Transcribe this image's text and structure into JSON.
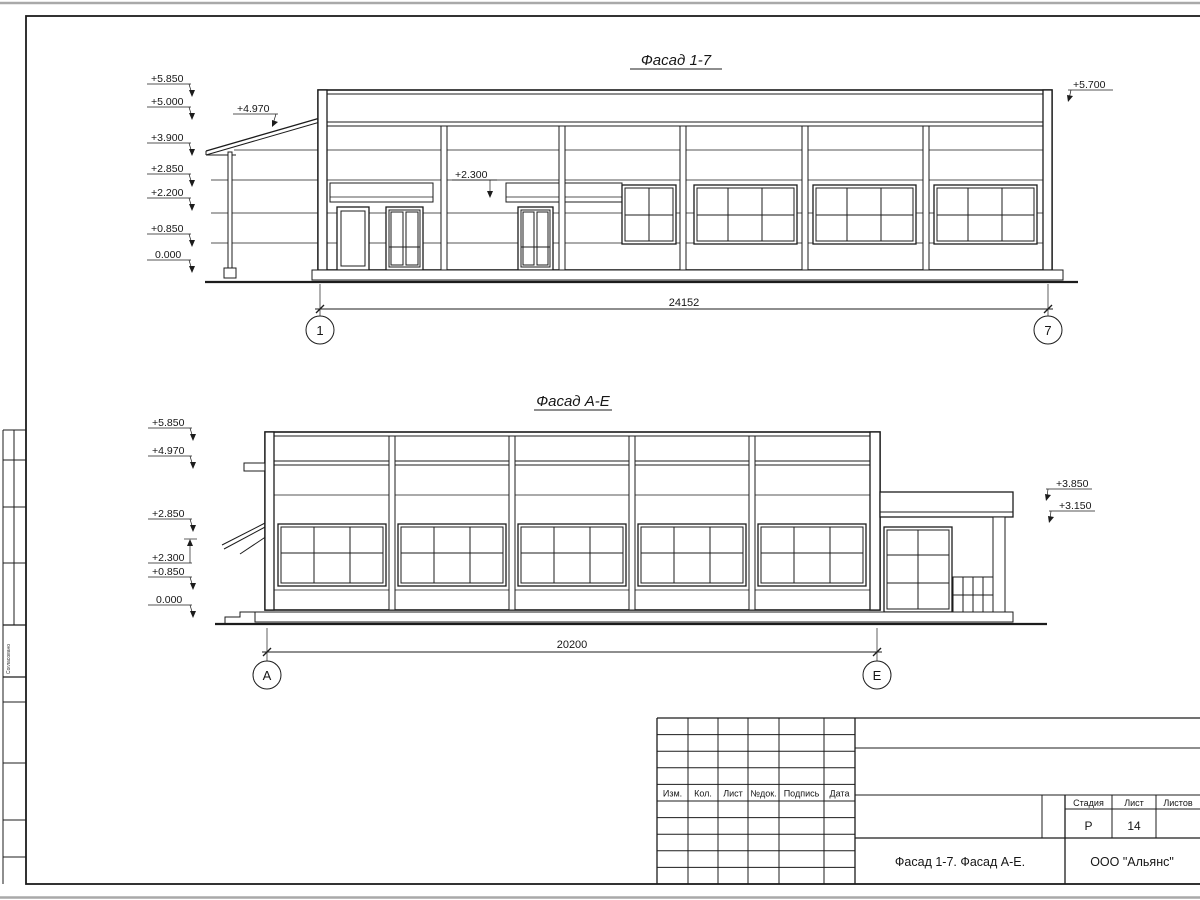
{
  "facades": {
    "facade_1_7": {
      "title": "Фасад 1-7",
      "dimension_mm": "24152",
      "axis_left": "1",
      "axis_right": "7",
      "elevation_marks_left": [
        "+5.850",
        "+5.000",
        "+3.900",
        "+2.850",
        "+2.200",
        "+0.850",
        "0.000"
      ],
      "elevation_mark_canopy": "+4.970",
      "elevation_mark_entrance": "+2.300",
      "elevation_mark_right": "+5.700"
    },
    "facade_a_e": {
      "title": "Фасад А-Е",
      "dimension_mm": "20200",
      "axis_left": "А",
      "axis_right": "Е",
      "elevation_marks_left": [
        "+5.850",
        "+4.970",
        "+2.850",
        "+2.300",
        "+0.850",
        "0.000"
      ],
      "elevation_marks_right": [
        "+3.850",
        "+3.150"
      ]
    }
  },
  "title_block": {
    "revision_columns": [
      "Изм.",
      "Кол.",
      "Лист",
      "№док.",
      "Подпись",
      "Дата"
    ],
    "stage_label": "Стадия",
    "stage_value": "Р",
    "sheet_label": "Лист",
    "sheet_value": "14",
    "sheets_total_label": "Листов",
    "sheets_total_value": "",
    "doc_title": "Фасад 1-7. Фасад А-Е.",
    "company": "ООО \"Альянс\""
  },
  "side_stamp": {
    "vertical_text": "Согласовано"
  }
}
